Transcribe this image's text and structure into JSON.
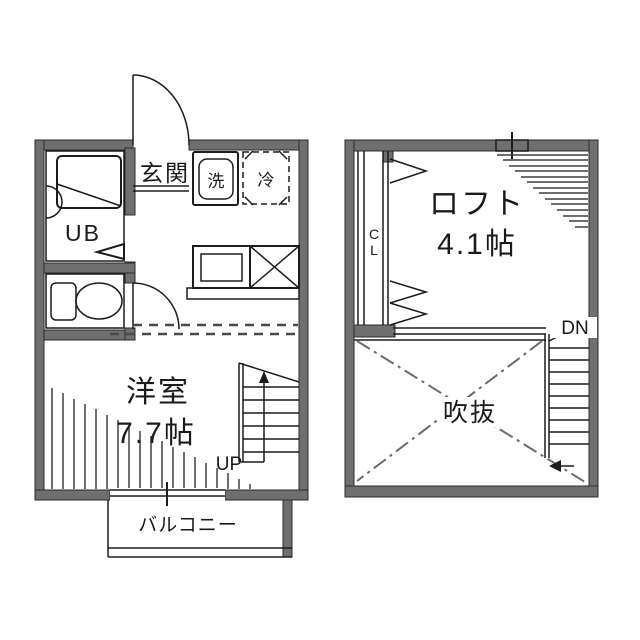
{
  "colors": {
    "wall": "#6f6f6f",
    "line": "#1c1c1c",
    "background": "#ffffff"
  },
  "floor1": {
    "entrance_label": "玄関",
    "washer_label": "洗",
    "fridge_label": "冷",
    "unit_bath_label": "UB",
    "room_label": "洋室",
    "room_size_label": "7.7帖",
    "stairs_label": "UP",
    "balcony_label": "バルコニー"
  },
  "floor2": {
    "loft_label": "ロフト",
    "loft_size_label": "4.1帖",
    "closet_label": "CL",
    "stairs_label": "DN",
    "void_label": "吹抜"
  }
}
